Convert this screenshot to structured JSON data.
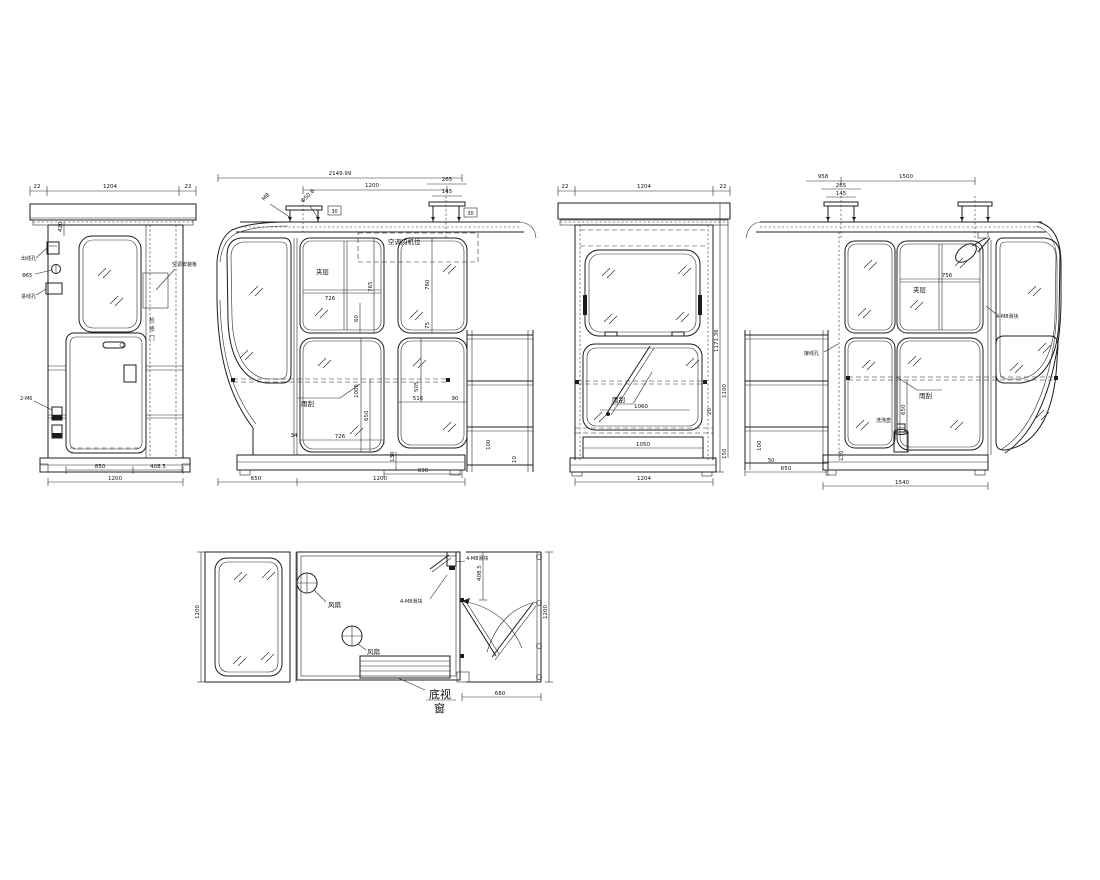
{
  "colors": {
    "line": "#1c1c1c",
    "background": "#ffffff"
  },
  "drawing": {
    "v1": {
      "dim_gap_l": "22",
      "dim_width": "1204",
      "dim_gap_r": "22",
      "dim_420": "420",
      "lbl_outlet": "出线孔",
      "lbl_phi": "Φ65",
      "lbl_inlet": "进线孔",
      "lbl_bolt": "2-M6",
      "lbl_ac_plate": "空调安装板",
      "lbl_door": "检修门",
      "dim_850": "850",
      "dim_4085": "408.5",
      "dim_1200": "1200"
    },
    "v2": {
      "dim_total": "2149.99",
      "dim_1200": "1200",
      "dim_265": "265",
      "dim_145": "145",
      "lbl_m8": "M8",
      "lbl_phi508": "Φ50.8",
      "dim_30a": "30",
      "dim_30b": "30",
      "lbl_ac": "空调内机位",
      "lbl_glass": "夹层",
      "dim_726": "726",
      "dim_765": "765",
      "dim_60": "60",
      "dim_780": "780",
      "dim_75": "75",
      "lbl_wiper": "雨刮",
      "dim_1005": "1005",
      "dim_650v": "650",
      "dim_505": "505",
      "dim_516": "516",
      "dim_90": "90",
      "dim_34": "34",
      "dim_726b": "726",
      "dim_130": "130",
      "dim_690": "690",
      "dim_650": "650",
      "dim_1200b": "1200",
      "dim_100": "100",
      "dim_10": "10"
    },
    "v3": {
      "dim_gap_l": "22",
      "dim_width": "1204",
      "dim_gap_r": "22",
      "lbl_wiper": "雨刮",
      "dim_1060": "1060",
      "dim_1050": "1050",
      "dim_1204": "1204",
      "dim_height": "1171.36",
      "dim_1100": "1100",
      "dim_20": "20",
      "dim_150": "150"
    },
    "v4": {
      "dim_958": "958",
      "dim_265": "265",
      "dim_145": "145",
      "dim_1500": "1500",
      "lbl_glass": "夹层",
      "dim_756": "756",
      "lbl_slider": "4-M8滑块",
      "lbl_wire": "接线孔",
      "lbl_wiper": "雨刮",
      "dim_650v": "650",
      "lbl_washer": "洗涤壶",
      "dim_100": "100",
      "dim_50": "50",
      "dim_650": "650",
      "dim_130": "130",
      "dim_1540": "1540"
    },
    "v5": {
      "dim_1200l": "1200",
      "dim_1200r": "1200",
      "dim_4085": "408.5",
      "dim_680": "680",
      "lbl_fan1": "风扇",
      "lbl_fan2": "风扇",
      "lbl_slider1": "4-M8滑块",
      "lbl_slider2": "4-M8滑块",
      "lbl_bottom1": "底视",
      "lbl_bottom2": "窗"
    }
  }
}
